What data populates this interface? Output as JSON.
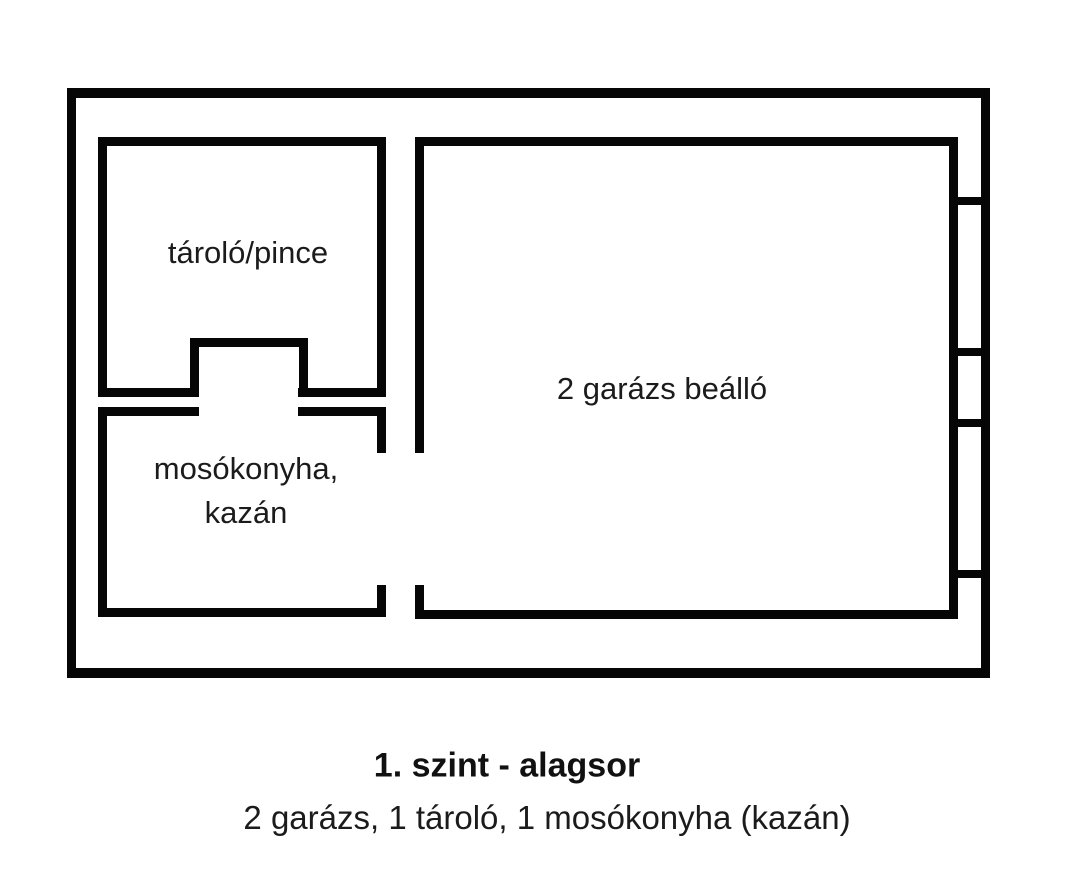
{
  "floor_plan": {
    "rooms": {
      "storage": {
        "label": "tároló/pince"
      },
      "laundry": {
        "label_line1": "mosókonyha,",
        "label_line2": "kazán"
      },
      "garage": {
        "label": "2 garázs beálló"
      }
    },
    "caption": {
      "title": "1. szint - alagsor",
      "subtitle": "2 garázs, 1 tároló, 1 mosókonyha (kazán)"
    },
    "colors": {
      "wall": "#060606",
      "background": "#ffffff",
      "text": "#1b1b1b"
    }
  }
}
